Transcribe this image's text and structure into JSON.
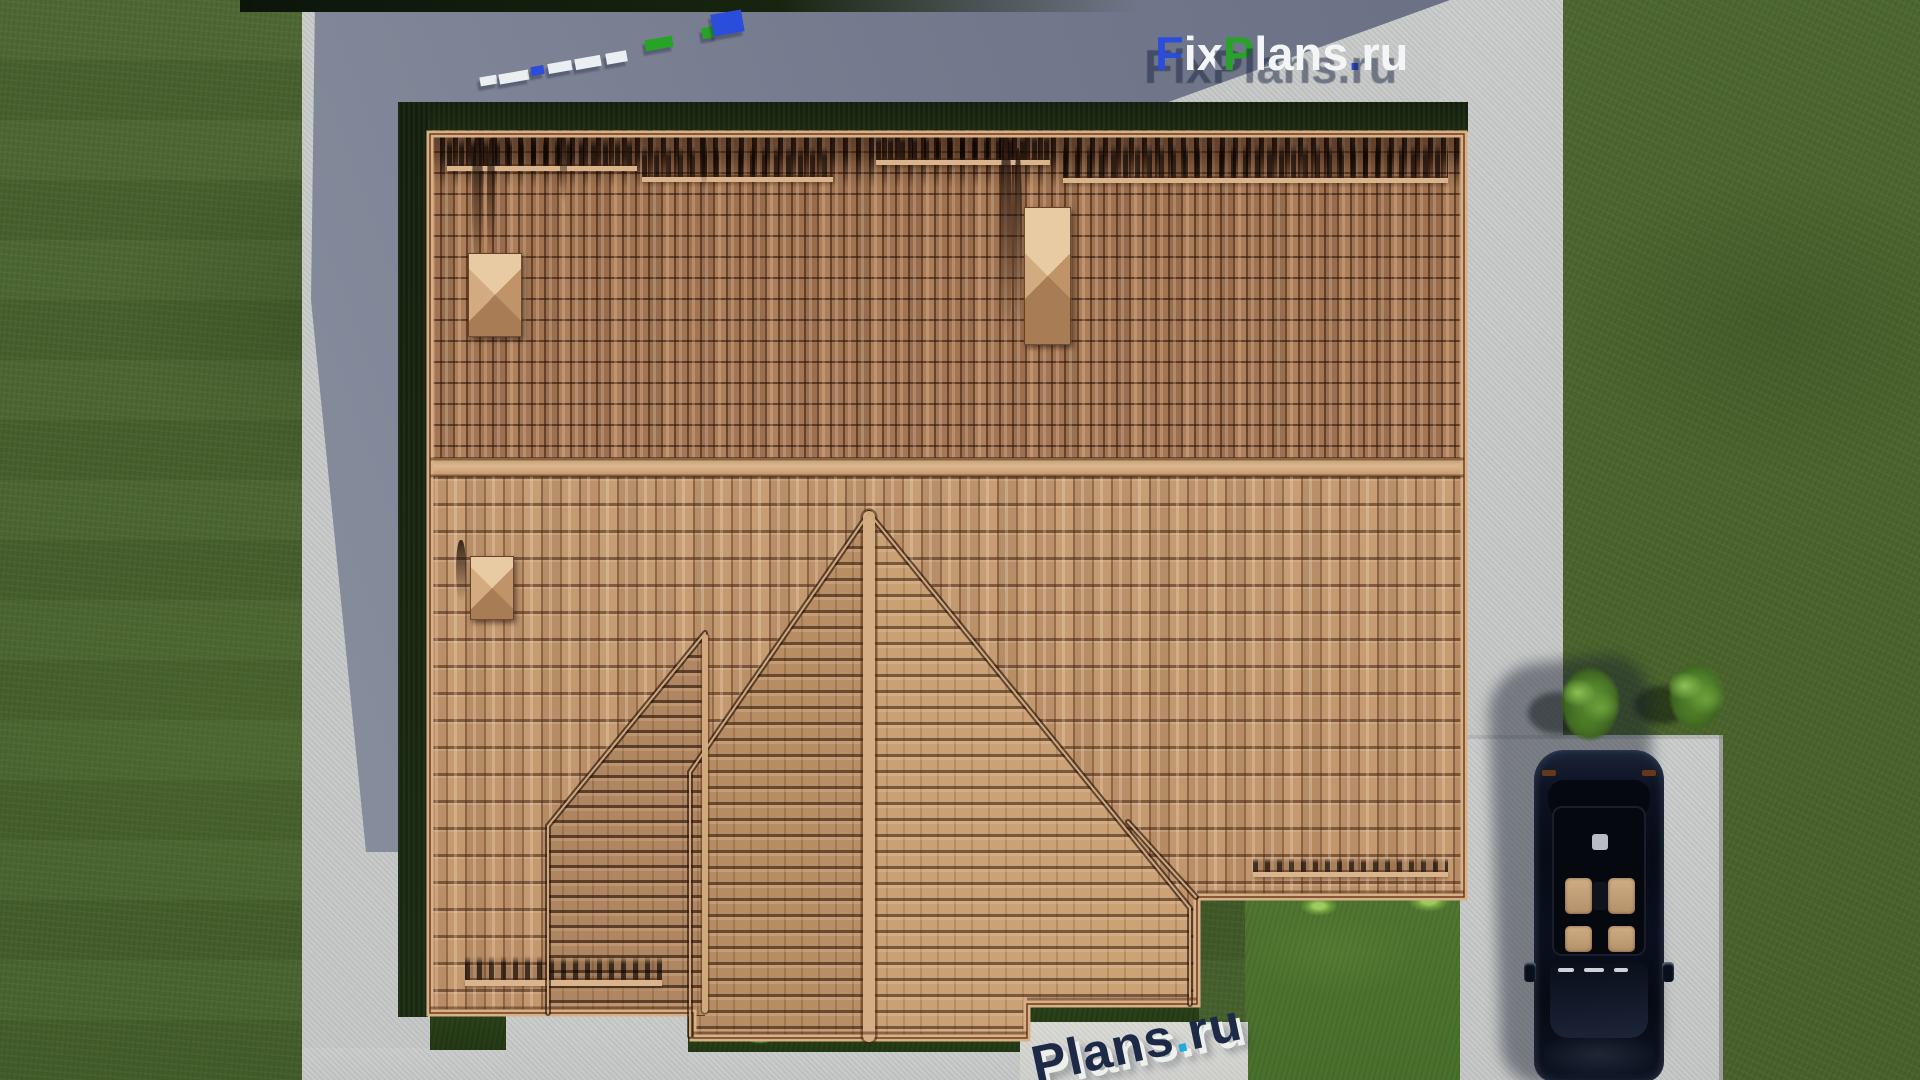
{
  "scene": {
    "type": "aerial-3d-architecture-render",
    "subject": "Top-down view of a house with a terracotta tiled roof, lawn, concrete paths and a parked black car",
    "logo": {
      "f": "F",
      "ix": "ix",
      "p": "P",
      "lans": "lans",
      "dot": ".",
      "ru": "ru",
      "blue": "#2b4ddb",
      "green": "#27a327",
      "white": "#f3f5f7",
      "shadow_navy": "#1a2340"
    },
    "ground_watermark": {
      "word": "Plans",
      "dot": ".",
      "tld": "ru",
      "letter_color": "#1c2a47",
      "dot_color": "#21aadd"
    },
    "palette": {
      "grass": "#48622e",
      "grass_bright": "#507431",
      "pavement": "#c8cac9",
      "cast_shadow": "#737990",
      "roof_upper": "#aa7d58",
      "roof_lower": "#c79d74",
      "roof_trim": "#d9b086",
      "hedge": "#15230f",
      "car_body": "#0b1120"
    }
  }
}
